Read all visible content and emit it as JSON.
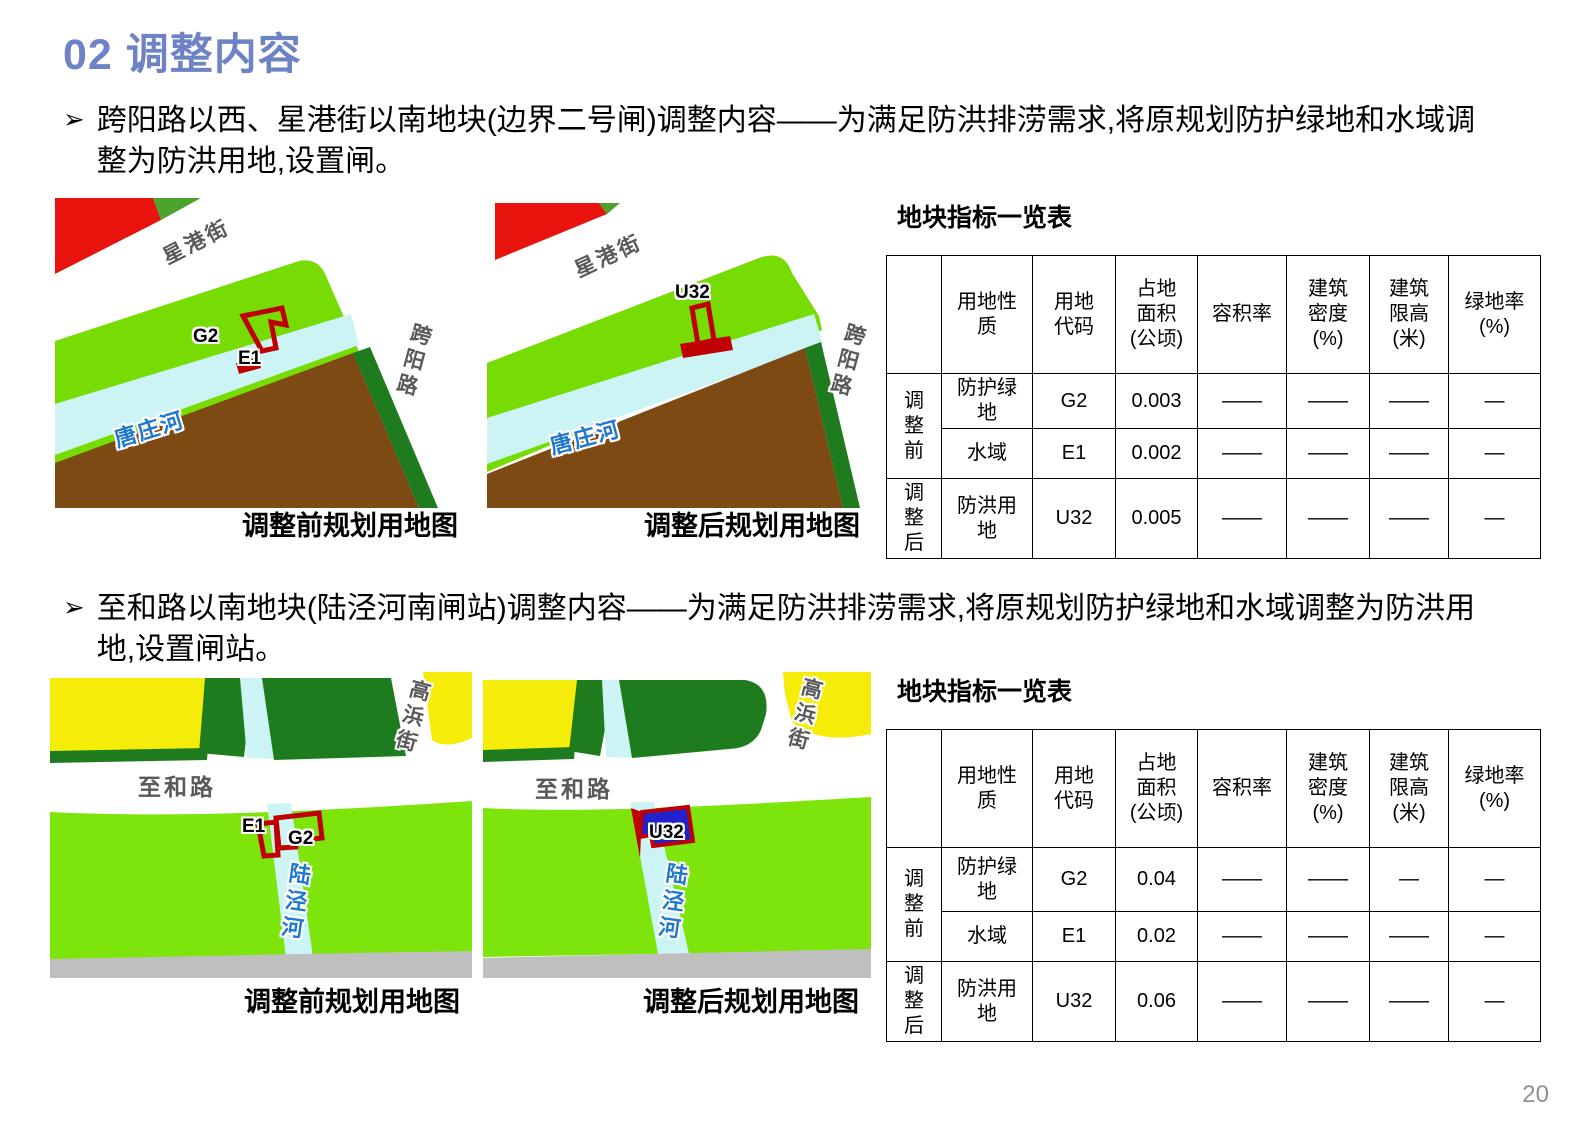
{
  "title": "02 调整内容",
  "bullets": [
    {
      "marker": "➢",
      "text": "跨阳路以西、星港街以南地块(边界二号闸)调整内容——为满足防洪排涝需求,将原规划防护绿地和水域调整为防洪用地,设置闸。"
    },
    {
      "marker": "➢",
      "text": "至和路以南地块(陆泾河南闸站)调整内容——为满足防洪排涝需求,将原规划防护绿地和水域调整为防洪用地,设置闸站。"
    }
  ],
  "maps": {
    "m1": {
      "caption": "调整前规划用地图",
      "street": "星港街",
      "road": "跨阳路",
      "river": "唐庄河",
      "g2": "G2",
      "e1": "E1"
    },
    "m2": {
      "caption": "调整后规划用地图",
      "street": "星港街",
      "road": "跨阳路",
      "river": "唐庄河",
      "u32": "U32"
    },
    "m3": {
      "caption": "调整前规划用地图",
      "street": "高浜街",
      "road": "至和路",
      "river": "陆泾河",
      "g2": "G2",
      "e1": "E1"
    },
    "m4": {
      "caption": "调整后规划用地图",
      "street": "高浜街",
      "road": "至和路",
      "river": "陆泾河",
      "u32": "U32"
    }
  },
  "tables": {
    "headers": [
      "",
      "用地性质",
      "用地代码",
      "占地面积(公顷)",
      "容积率",
      "建筑密度(%)",
      "建筑限高(米)",
      "绿地率(%)"
    ],
    "t1": {
      "title": "地块指标一览表",
      "rows": [
        {
          "group": "调整前",
          "name": "防护绿地",
          "code": "G2",
          "area": "0.003",
          "far": "——",
          "density": "——",
          "height": "——",
          "green": "—"
        },
        {
          "name": "水域",
          "code": "E1",
          "area": "0.002",
          "far": "——",
          "density": "——",
          "height": "——",
          "green": "—"
        },
        {
          "group": "调整后",
          "name": "防洪用地",
          "code": "U32",
          "area": "0.005",
          "far": "——",
          "density": "——",
          "height": "——",
          "green": "—"
        }
      ]
    },
    "t2": {
      "title": "地块指标一览表",
      "rows": [
        {
          "group": "调整前",
          "name": "防护绿地",
          "code": "G2",
          "area": "0.04",
          "far": "——",
          "density": "——",
          "height": "—",
          "green": "—"
        },
        {
          "name": "水域",
          "code": "E1",
          "area": "0.02",
          "far": "——",
          "density": "——",
          "height": "——",
          "green": "—"
        },
        {
          "group": "调整后",
          "name": "防洪用地",
          "code": "U32",
          "area": "0.06",
          "far": "——",
          "density": "——",
          "height": "——",
          "green": "—"
        }
      ]
    }
  },
  "colors": {
    "title_blue": "#6D83C5",
    "parcel_red": "#E8130C",
    "protective_green": "#77DB04",
    "bright_green": "#7DE40C",
    "medium_green": "#4BA32C",
    "dark_green": "#1E7C1E",
    "river_cyan": "#CDF4F4",
    "village_brown": "#7C4A12",
    "industrial_yellow": "#F5EC0A",
    "road_gray": "#BFBFBF",
    "marker_red": "#C00000",
    "flood_parcel_blue": "#2222CC",
    "river_label_blue": "#1F78CC",
    "road_label_gray": "#595959"
  },
  "page": {
    "number": "20"
  }
}
